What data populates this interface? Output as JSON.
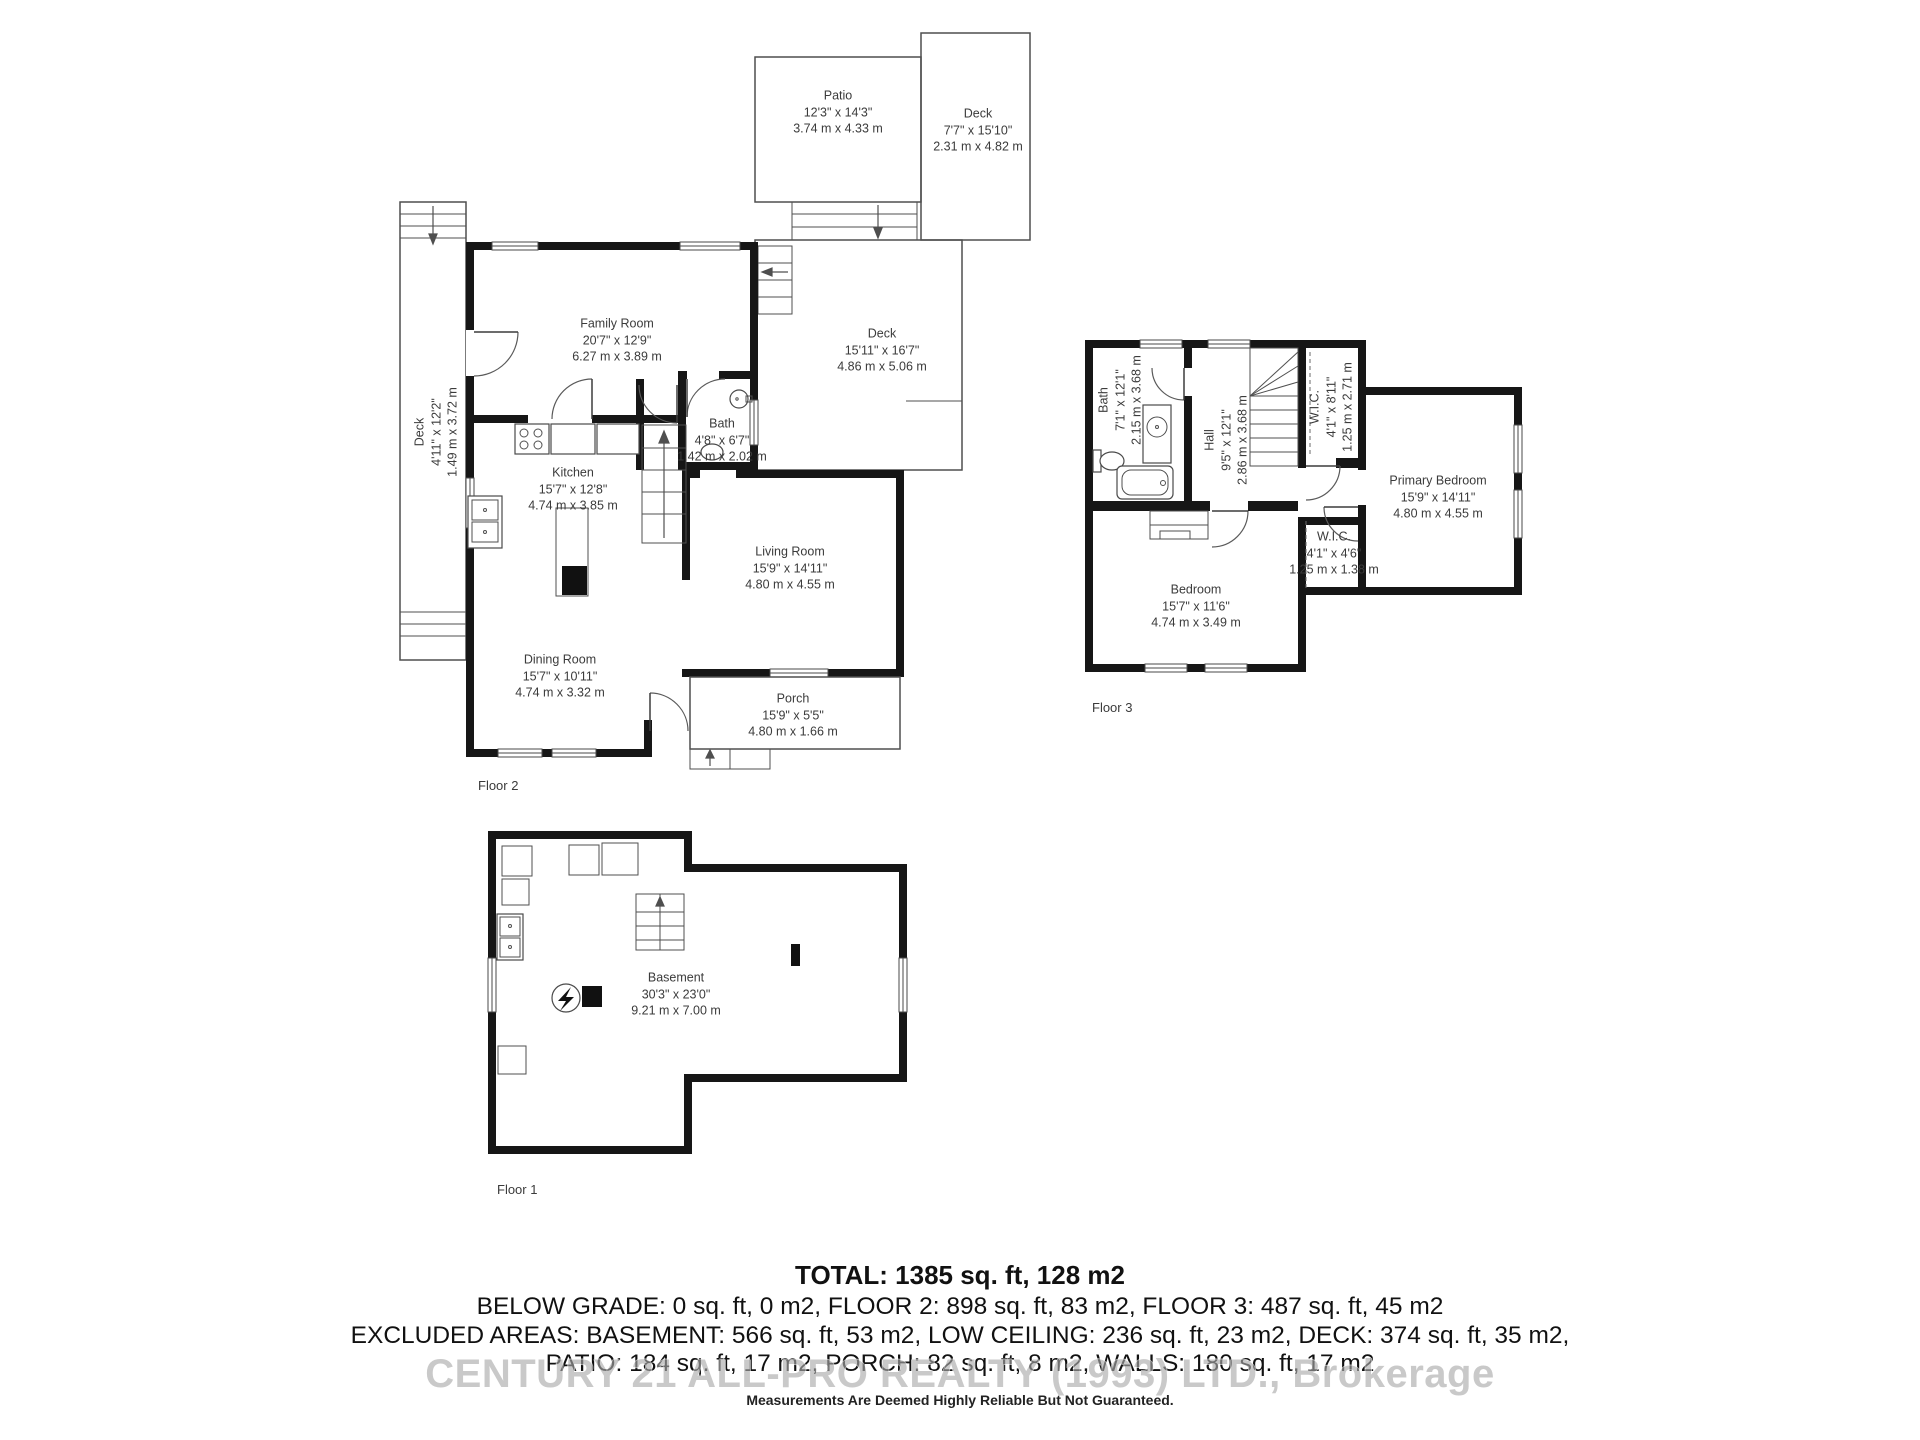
{
  "floor2": {
    "label": "Floor 2",
    "rooms": {
      "patio": {
        "name": "Patio",
        "imperial": "12'3\" x 14'3\"",
        "metric": "3.74 m x 4.33 m"
      },
      "deck_upper": {
        "name": "Deck",
        "imperial": "7'7\" x 15'10\"",
        "metric": "2.31 m x 4.82 m"
      },
      "deck_left": {
        "name": "Deck",
        "imperial": "4'11\" x 12'2\"",
        "metric": "1.49 m x 3.72 m"
      },
      "family_room": {
        "name": "Family Room",
        "imperial": "20'7\" x 12'9\"",
        "metric": "6.27 m x 3.89 m"
      },
      "deck_main": {
        "name": "Deck",
        "imperial": "15'11\" x 16'7\"",
        "metric": "4.86 m x 5.06 m"
      },
      "bath": {
        "name": "Bath",
        "imperial": "4'8\" x 6'7\"",
        "metric": "1.42 m x 2.02 m"
      },
      "kitchen": {
        "name": "Kitchen",
        "imperial": "15'7\" x 12'8\"",
        "metric": "4.74 m x 3.85 m"
      },
      "living_room": {
        "name": "Living Room",
        "imperial": "15'9\" x 14'11\"",
        "metric": "4.80 m x 4.55 m"
      },
      "dining_room": {
        "name": "Dining Room",
        "imperial": "15'7\" x 10'11\"",
        "metric": "4.74 m x 3.32 m"
      },
      "porch": {
        "name": "Porch",
        "imperial": "15'9\" x 5'5\"",
        "metric": "4.80 m x 1.66 m"
      }
    }
  },
  "floor3": {
    "label": "Floor 3",
    "rooms": {
      "bath": {
        "name": "Bath",
        "imperial": "7'1\" x 12'1\"",
        "metric": "2.15 m x 3.68 m"
      },
      "hall": {
        "name": "Hall",
        "imperial": "9'5\" x 12'1\"",
        "metric": "2.86 m x 3.68 m"
      },
      "wic_large": {
        "name": "W.I.C.",
        "imperial": "4'1\" x 8'11\"",
        "metric": "1.25 m x 2.71 m"
      },
      "primary_bedroom": {
        "name": "Primary Bedroom",
        "imperial": "15'9\" x 14'11\"",
        "metric": "4.80 m x 4.55 m"
      },
      "wic_small": {
        "name": "W.I.C.",
        "imperial": "4'1\" x 4'6\"",
        "metric": "1.25 m x 1.38 m"
      },
      "bedroom": {
        "name": "Bedroom",
        "imperial": "15'7\" x 11'6\"",
        "metric": "4.74 m x 3.49 m"
      }
    }
  },
  "floor1": {
    "label": "Floor 1",
    "rooms": {
      "basement": {
        "name": "Basement",
        "imperial": "30'3\" x 23'0\"",
        "metric": "9.21 m x 7.00 m"
      }
    }
  },
  "summary": {
    "total": "TOTAL: 1385 sq. ft, 128 m2",
    "line2": "BELOW GRADE: 0 sq. ft, 0 m2, FLOOR 2: 898 sq. ft, 83 m2, FLOOR 3: 487 sq. ft, 45 m2",
    "line3": "EXCLUDED AREAS: BASEMENT: 566 sq. ft, 53 m2, LOW CEILING: 236 sq. ft, 23 m2, DECK: 374 sq. ft, 35 m2,",
    "line4": "PATIO: 184 sq. ft, 17 m2, PORCH: 82 sq. ft, 8 m2, WALLS: 180 sq. ft, 17 m2",
    "watermark": "CENTURY 21 ALL-PRO REALTY (1993) LTD., Brokerage",
    "disclaimer": "Measurements Are Deemed Highly Reliable But Not Guaranteed."
  },
  "colors": {
    "wall": "#161616",
    "thin_line": "#4f4f4f",
    "label_text": "#3b3b3b",
    "watermark_gray": "#a9a9a9",
    "background": "#ffffff"
  }
}
